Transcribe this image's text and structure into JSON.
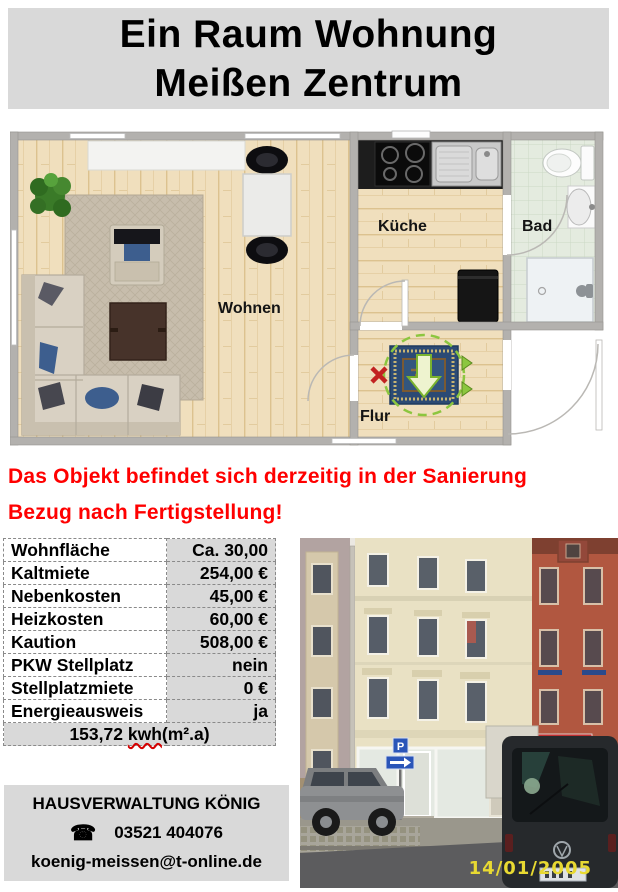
{
  "title": {
    "line1": "Ein Raum Wohnung",
    "line2": "Meißen Zentrum"
  },
  "floorplan": {
    "labels": {
      "living": "Wohnen",
      "kitchen": "Küche",
      "bath": "Bad",
      "hall": "Flur"
    }
  },
  "notice": {
    "line1": "Das Objekt befindet sich derzeitig in der Sanierung",
    "line2": "Bezug nach Fertigstellung!"
  },
  "details": {
    "rows": [
      {
        "label": "Wohnfläche",
        "value": "Ca. 30,00"
      },
      {
        "label": "Kaltmiete",
        "value": "254,00 €"
      },
      {
        "label": "Nebenkosten",
        "value": "45,00 €"
      },
      {
        "label": "Heizkosten",
        "value": "60,00 €"
      },
      {
        "label": "Kaution",
        "value": "508,00 €"
      },
      {
        "label": "PKW Stellplatz",
        "value": "nein"
      },
      {
        "label": "Stellplatzmiete",
        "value": "0 €"
      },
      {
        "label": "Energieausweis",
        "value": "ja"
      }
    ],
    "energy": {
      "value": "153,72 ",
      "unit": "kwh",
      "suffix": "(m².a)"
    }
  },
  "photo": {
    "date_stamp": "14/01/2005",
    "parking_sign_letter": "P"
  },
  "contact": {
    "company": "HAUSVERWALTUNG KÖNIG",
    "phone_icon": "☎",
    "phone": "03521 404076",
    "email": "koenig-meissen@t-online.de"
  },
  "colors": {
    "panel_gray": "#d9d9d9",
    "notice_red": "#ff0000",
    "date_yellow": "#e8d932"
  }
}
